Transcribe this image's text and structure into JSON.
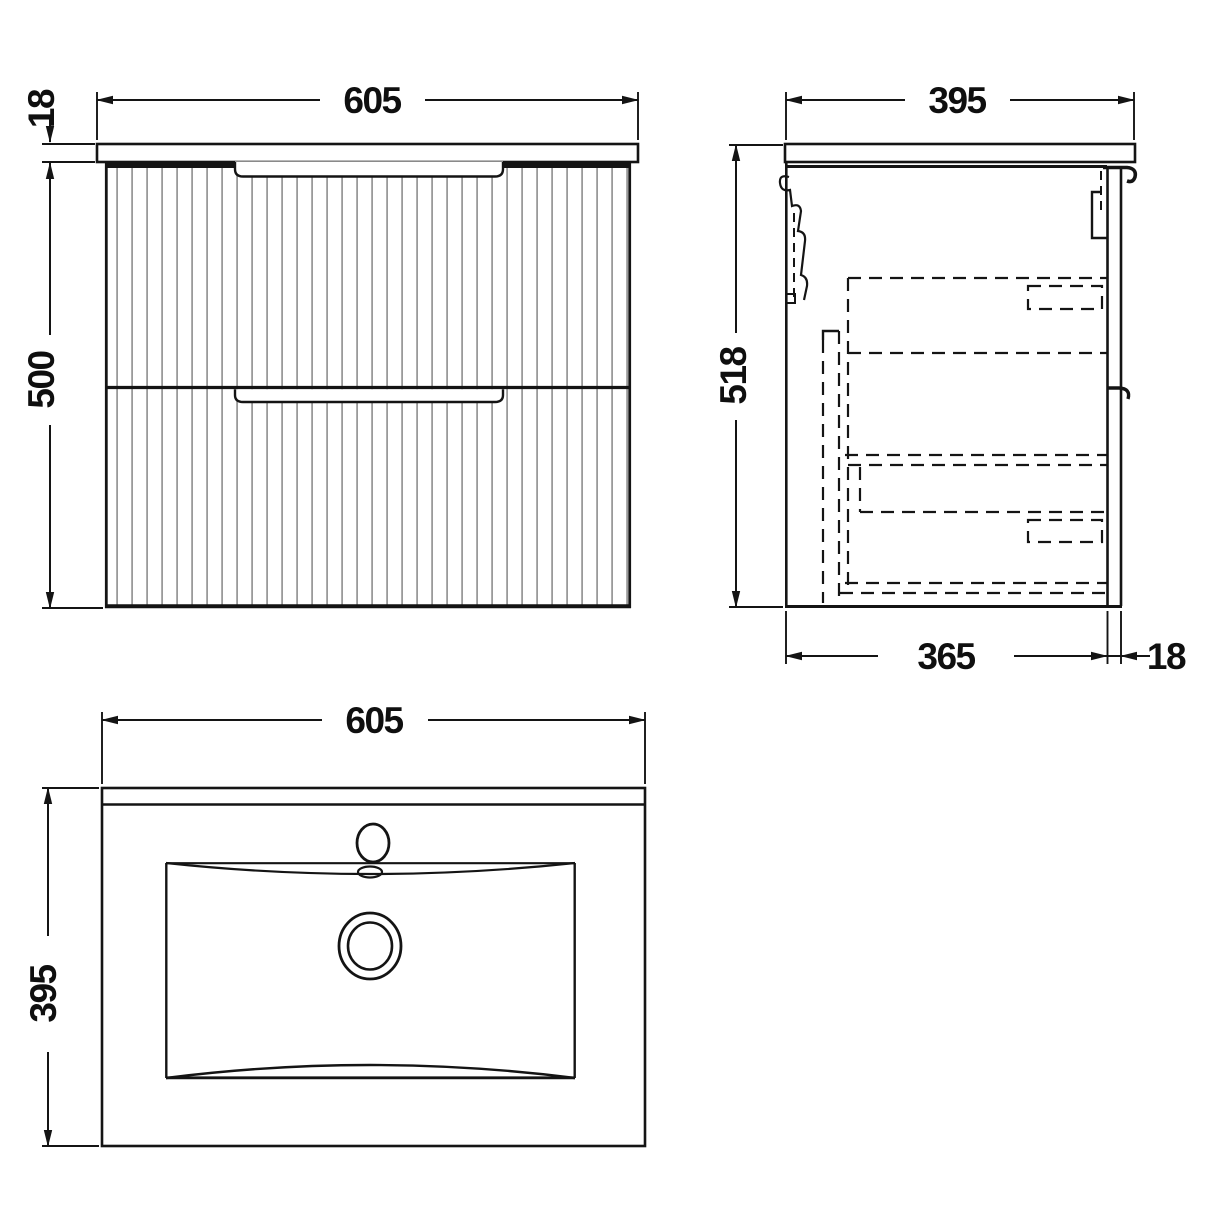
{
  "views": {
    "front": {
      "width": "605",
      "worktop_thickness": "18",
      "cabinet_height": "500"
    },
    "side": {
      "depth": "395",
      "overall_height": "518",
      "carcass_depth": "365",
      "front_panel_thickness": "18"
    },
    "basin": {
      "width": "605",
      "depth": "395"
    }
  },
  "style": {
    "line_color": "#141414",
    "flute_color": "#9a9a9a",
    "background": "#ffffff"
  }
}
